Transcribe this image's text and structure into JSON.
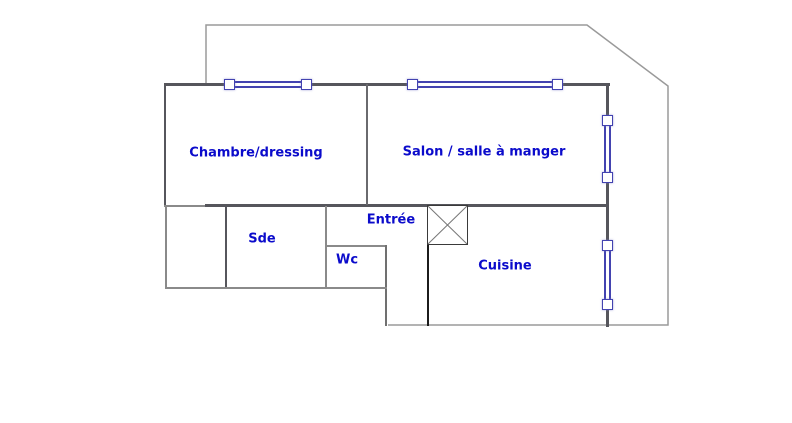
{
  "colors": {
    "room_label": "#0b0bcb",
    "window_frame": "#4343b0",
    "wall_dark": "#56565c",
    "wall_medium": "#8a8a8a",
    "outline_light": "#9a9a9a",
    "divider_black": "#1c1c1c",
    "background": "#ffffff"
  },
  "rooms": [
    {
      "id": "chambre",
      "label": "Chambre/dressing"
    },
    {
      "id": "salon",
      "label": "Salon / salle à manger"
    },
    {
      "id": "sde",
      "label": "Sde"
    },
    {
      "id": "wc",
      "label": "Wc"
    },
    {
      "id": "entree",
      "label": "Entrée"
    },
    {
      "id": "cuisine",
      "label": "Cuisine"
    }
  ],
  "windows": [
    {
      "id": "chambre-top-window",
      "orientation": "horizontal"
    },
    {
      "id": "salon-top-window",
      "orientation": "horizontal"
    },
    {
      "id": "right-wall-window-upper",
      "orientation": "vertical"
    },
    {
      "id": "right-wall-window-lower",
      "orientation": "vertical"
    }
  ],
  "symbols": [
    {
      "id": "crossed-square",
      "meaning": "shaft / duct symbol"
    }
  ]
}
